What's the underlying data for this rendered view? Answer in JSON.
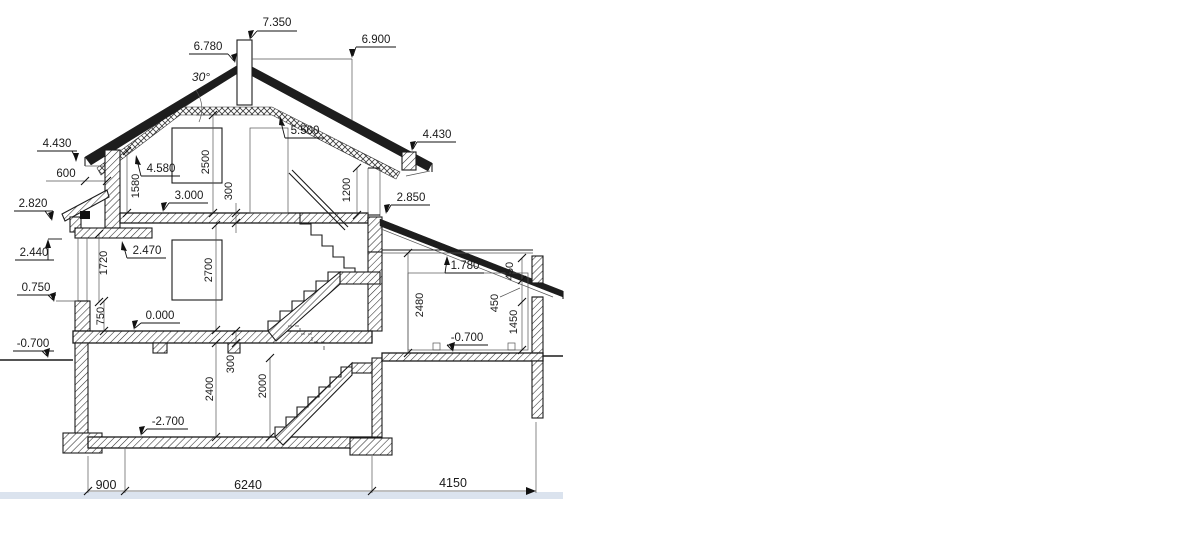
{
  "drawing": {
    "title": "house-cross-section",
    "roof_angle": "30°",
    "colors": {
      "linework": "#1a1a1a",
      "footer_strip": "#dbe3ee"
    },
    "elevations": {
      "chimney_top": "7.350",
      "ridge": "6.780",
      "roof_right": "6.900",
      "collar_ceiling": "5.500",
      "kneewall_top": "4.580",
      "eaves_left": "4.430",
      "eaves_right": "4.430",
      "attic_floor": "3.000",
      "canopy_top": "2.820",
      "annex_roof": "2.850",
      "gf_ceiling": "2.470",
      "canopy_soffit": "2.440",
      "annex_ceiling": "1.780",
      "sill_left": "0.750",
      "ground_floor": "0.000",
      "ground_level": "-0.700",
      "annex_floor": "-0.700",
      "basement_floor": "-2.700"
    },
    "vertical_dimensions": {
      "attic_room_height": "2500",
      "kneewall_height": "1580",
      "attic_slab_thickness": "300",
      "upper_window_height": "1200",
      "gf_window_height": "1720",
      "gf_room_height": "2700",
      "plinth_height": "750",
      "gf_slab_thickness": "300",
      "basement_room_height": "2400",
      "basement_stair_clearance": "2000",
      "annex_room_height": "2480",
      "annex_450_upper": "450",
      "annex_450_lower": "450",
      "annex_sill_height": "1450"
    },
    "horizontal_dimensions": {
      "eaves_overhang": "600",
      "left_bay": "900",
      "main_span": "6240",
      "annex_span": "4150"
    }
  }
}
